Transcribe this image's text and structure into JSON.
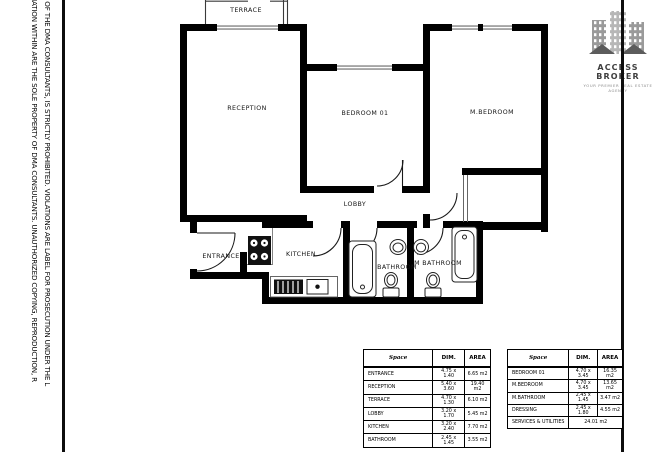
{
  "disclaimer": {
    "line1": "MATION WITHIN ARE THE SOLE PROPERTY OF DMA CONSULTANTS. UNAUTHORIZED COPYING, REPRODUCTION, R",
    "line2": "T OF THE DMA CONSULTANTS, IS STRICTLY PROHIBITED. VIOLATIONS ARE LABEL FOR PROSECUTION UNDER THE L"
  },
  "logo": {
    "title": "ACCESS BROKER",
    "tagline": "YOUR PREMIER REAL ESTATE AGENCY"
  },
  "plan": {
    "wall_color": "#000000",
    "window_color": "#8f8f8f",
    "rooms": {
      "terrace": "TERRACE",
      "reception": "RECEPTION",
      "bedroom01": "BEDROOM 01",
      "mbedroom": "M.BEDROOM",
      "lobby": "LOBBY",
      "entrance": "ENTRANCE",
      "kitchen": "KITCHEN",
      "bathroom": "BATHROOM",
      "mbathroom": "M BATHROOM"
    }
  },
  "tables": {
    "left": {
      "headers": [
        "Space",
        "DIM.",
        "AREA"
      ],
      "rows": [
        {
          "name": "ENTRANCE",
          "dim": "4.75 x 1.40",
          "area": "6.65 m2"
        },
        {
          "name": "RECEPTION",
          "dim": "5.40 x 3.60",
          "area": "19.40 m2"
        },
        {
          "name": "TERRACE",
          "dim": "4.70 x 1.30",
          "area": "6.10 m2"
        },
        {
          "name": "LOBBY",
          "dim": "3.20 x 1.70",
          "area": "5.45 m2"
        },
        {
          "name": "KITCHEN",
          "dim": "3.20 x 2.40",
          "area": "7.70 m2"
        },
        {
          "name": "BATHROOM",
          "dim": "2.45 x 1.45",
          "area": "3.55 m2"
        }
      ]
    },
    "right": {
      "headers": [
        "Space",
        "DIM.",
        "AREA"
      ],
      "rows": [
        {
          "name": "BEDROOM 01",
          "dim": "4.70 x 3.45",
          "area": "16.35 m2"
        },
        {
          "name": "M.BEDROOM",
          "dim": "4.70 x 3.45",
          "area": "13.65 m2"
        },
        {
          "name": "M.BATHROOM",
          "dim": "2.45 x 1.45",
          "area": "3.47 m2"
        },
        {
          "name": "DRESSING",
          "dim": "2.45 x 1.80",
          "area": "4.55 m2"
        }
      ],
      "footer": {
        "label": "SERVICES & UTILITIES",
        "value": "24.01 m2"
      }
    }
  }
}
